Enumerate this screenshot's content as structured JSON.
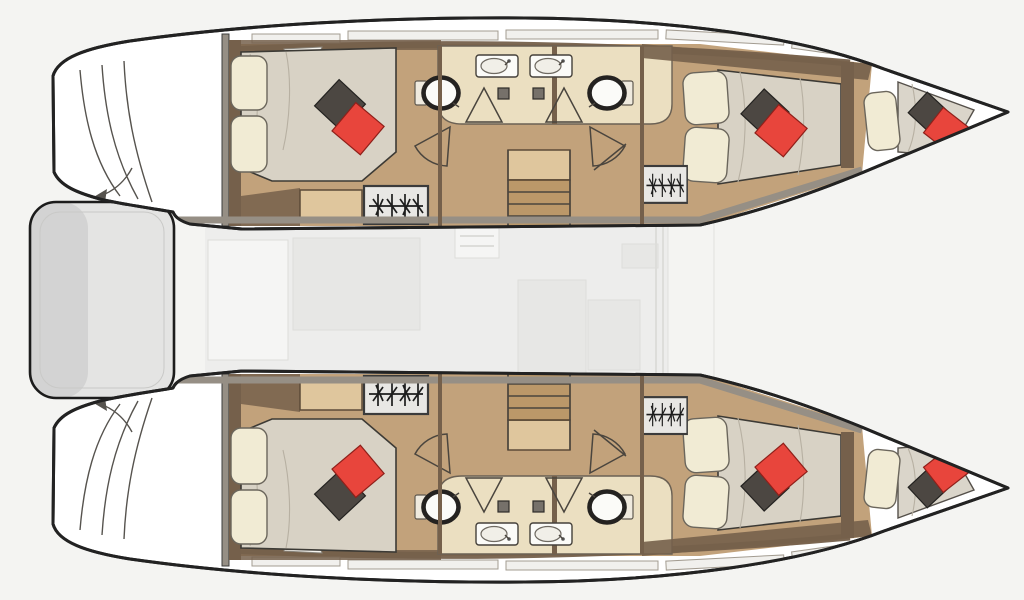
{
  "meta": {
    "title": "Catamaran yacht floor plan — top-down layout, bows to the right",
    "type": "floor-plan",
    "view": "top-down",
    "orientation": "bows-right"
  },
  "palette": {
    "bg": "#f4f4f2",
    "hull_fill": "#ffffff",
    "hull_stroke": "#222222",
    "wood_dark": "#75604b",
    "wood_mid": "#c2a27b",
    "wood_light": "#dfc69d",
    "wall_gray": "#968f85",
    "bed_fill": "#d8d2c5",
    "bed_stroke": "#3c3a35",
    "pillow_cream": "#f1ebd4",
    "pillow_dark": "#4c4742",
    "pillow_red": "#e8453c",
    "bath_floor": "#ebdfc1",
    "fixture_white": "#fbfbf8",
    "ghost_fill": "#ededec",
    "ghost_line": "#dcdcd9",
    "platform_fill": "#e4e4e3",
    "locker_fill": "#e8e7e4"
  },
  "plan": {
    "hulls": [
      {
        "name": "port-hull",
        "position": "top",
        "rooms": [
          {
            "name": "aft-double-cabin",
            "features": [
              "double-berth",
              "cream-pillows",
              "dark-pillow",
              "red-pillow",
              "hanging-locker"
            ]
          },
          {
            "name": "aft-bathroom",
            "features": [
              "toilet",
              "washbasin",
              "shower-door"
            ]
          },
          {
            "name": "fwd-bathroom",
            "features": [
              "toilet",
              "washbasin",
              "shower-door"
            ]
          },
          {
            "name": "companionway-stairs",
            "features": [
              "landing",
              "4-treads"
            ]
          },
          {
            "name": "fwd-double-cabin",
            "features": [
              "double-berth",
              "cream-pillows",
              "dark-pillow",
              "red-pillow",
              "hanging-locker"
            ]
          },
          {
            "name": "forepeak-berth",
            "features": [
              "single-berth",
              "cream-pillow",
              "dark-pillow",
              "red-pillow"
            ]
          }
        ]
      },
      {
        "name": "starboard-hull",
        "position": "bottom",
        "rooms": [
          {
            "name": "aft-double-cabin",
            "features": [
              "double-berth",
              "cream-pillows",
              "dark-pillow",
              "red-pillow",
              "hanging-locker"
            ]
          },
          {
            "name": "aft-bathroom",
            "features": [
              "toilet",
              "washbasin",
              "shower-door"
            ]
          },
          {
            "name": "fwd-bathroom",
            "features": [
              "toilet",
              "washbasin",
              "shower-door"
            ]
          },
          {
            "name": "companionway-stairs",
            "features": [
              "landing",
              "4-treads"
            ]
          },
          {
            "name": "fwd-double-cabin",
            "features": [
              "double-berth",
              "cream-pillows",
              "dark-pillow",
              "red-pillow",
              "hanging-locker"
            ]
          },
          {
            "name": "forepeak-berth",
            "features": [
              "single-berth",
              "cream-pillow",
              "dark-pillow",
              "red-pillow"
            ]
          }
        ]
      }
    ],
    "center": {
      "name": "salon-deck",
      "style": "faded-ghost-overlay"
    },
    "stern": {
      "name": "aft-platform",
      "features": [
        "transom-steps",
        "boarding-arrows"
      ]
    },
    "counts": {
      "cabins": 4,
      "bathrooms": 4,
      "berths": 6,
      "hanging_lockers": 4,
      "staircases": 2
    }
  }
}
